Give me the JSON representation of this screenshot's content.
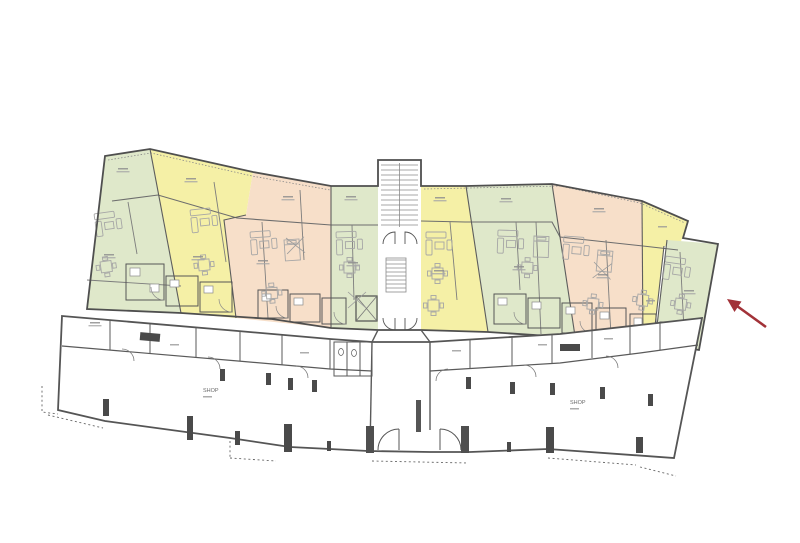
{
  "document": {
    "kind": "architectural floor plan",
    "description": "Residential building level plan: nine colored apartment units in an arced band above a ground row of shops; red arrow marks the rightmost green unit"
  },
  "palette": {
    "background": "#ffffff",
    "wall_dark": "#4f4f4f",
    "wall_mid": "#777777",
    "wall_light": "#9a9a9a",
    "unit_green": "#dfe8ca",
    "unit_yellow": "#f5f0a6",
    "unit_peach": "#f7dfc9",
    "furniture": "#a6a6a6",
    "arrow_red": "#a23238"
  },
  "apartments": {
    "units": [
      {
        "id": "unit-1",
        "color": "green"
      },
      {
        "id": "unit-2",
        "color": "yellow"
      },
      {
        "id": "unit-3",
        "color": "peach"
      },
      {
        "id": "unit-4",
        "color": "green"
      },
      {
        "id": "unit-5",
        "color": "yellow"
      },
      {
        "id": "unit-6",
        "color": "green"
      },
      {
        "id": "unit-7",
        "color": "peach"
      },
      {
        "id": "unit-8",
        "color": "yellow"
      },
      {
        "id": "unit-9",
        "color": "green",
        "highlighted_by_arrow": true
      }
    ],
    "stairwell": "central staircase",
    "elevator": "small green shaft beside staircase"
  },
  "shops": {
    "left": {
      "label": "SHOP"
    },
    "right": {
      "label": "SHOP"
    }
  },
  "annotation": {
    "arrow_color": "#a23238",
    "arrow_points_to": "unit-9"
  }
}
